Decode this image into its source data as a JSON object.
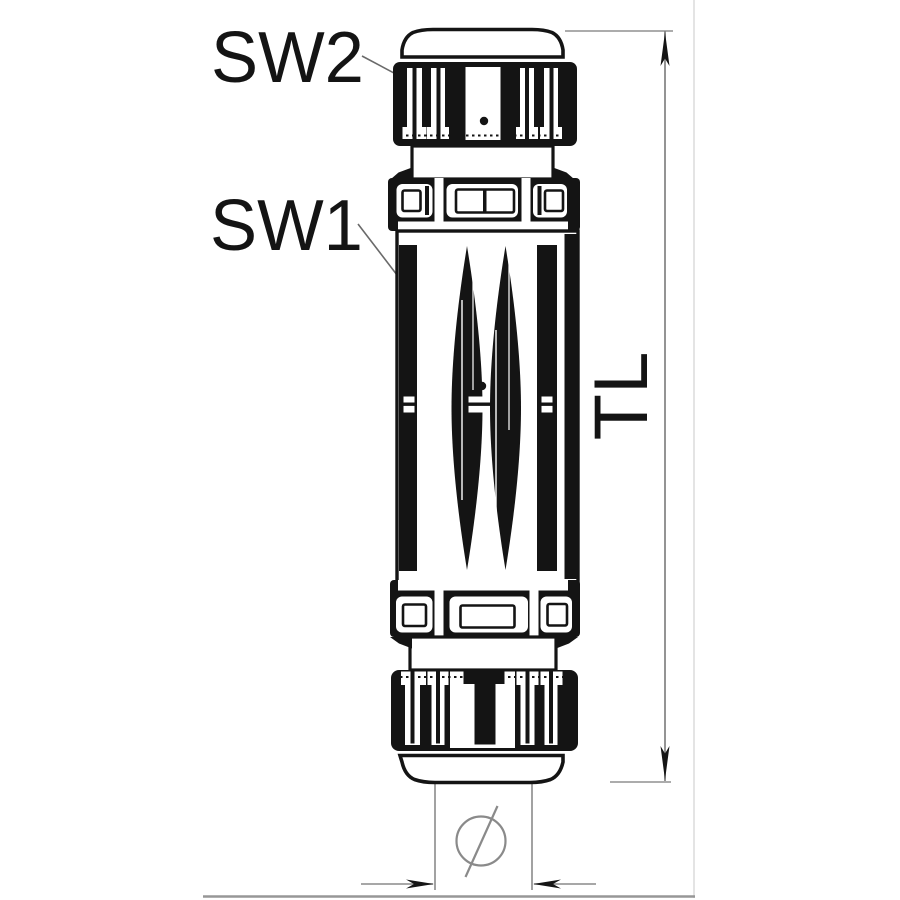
{
  "diagram": {
    "kind": "cable-gland technical line drawing, side view, with dimension callouts",
    "labels": {
      "sw2": "SW2",
      "sw1": "SW1",
      "total_length": "TL",
      "diameter": "Ø"
    }
  },
  "colors": {
    "ink": "#141414",
    "dimension_gray": "#7a7a7a",
    "leader_gray": "#6a6a6a",
    "background": "#ffffff",
    "frame_bottom": "#979797",
    "frame_right": "#e4e4e4"
  }
}
